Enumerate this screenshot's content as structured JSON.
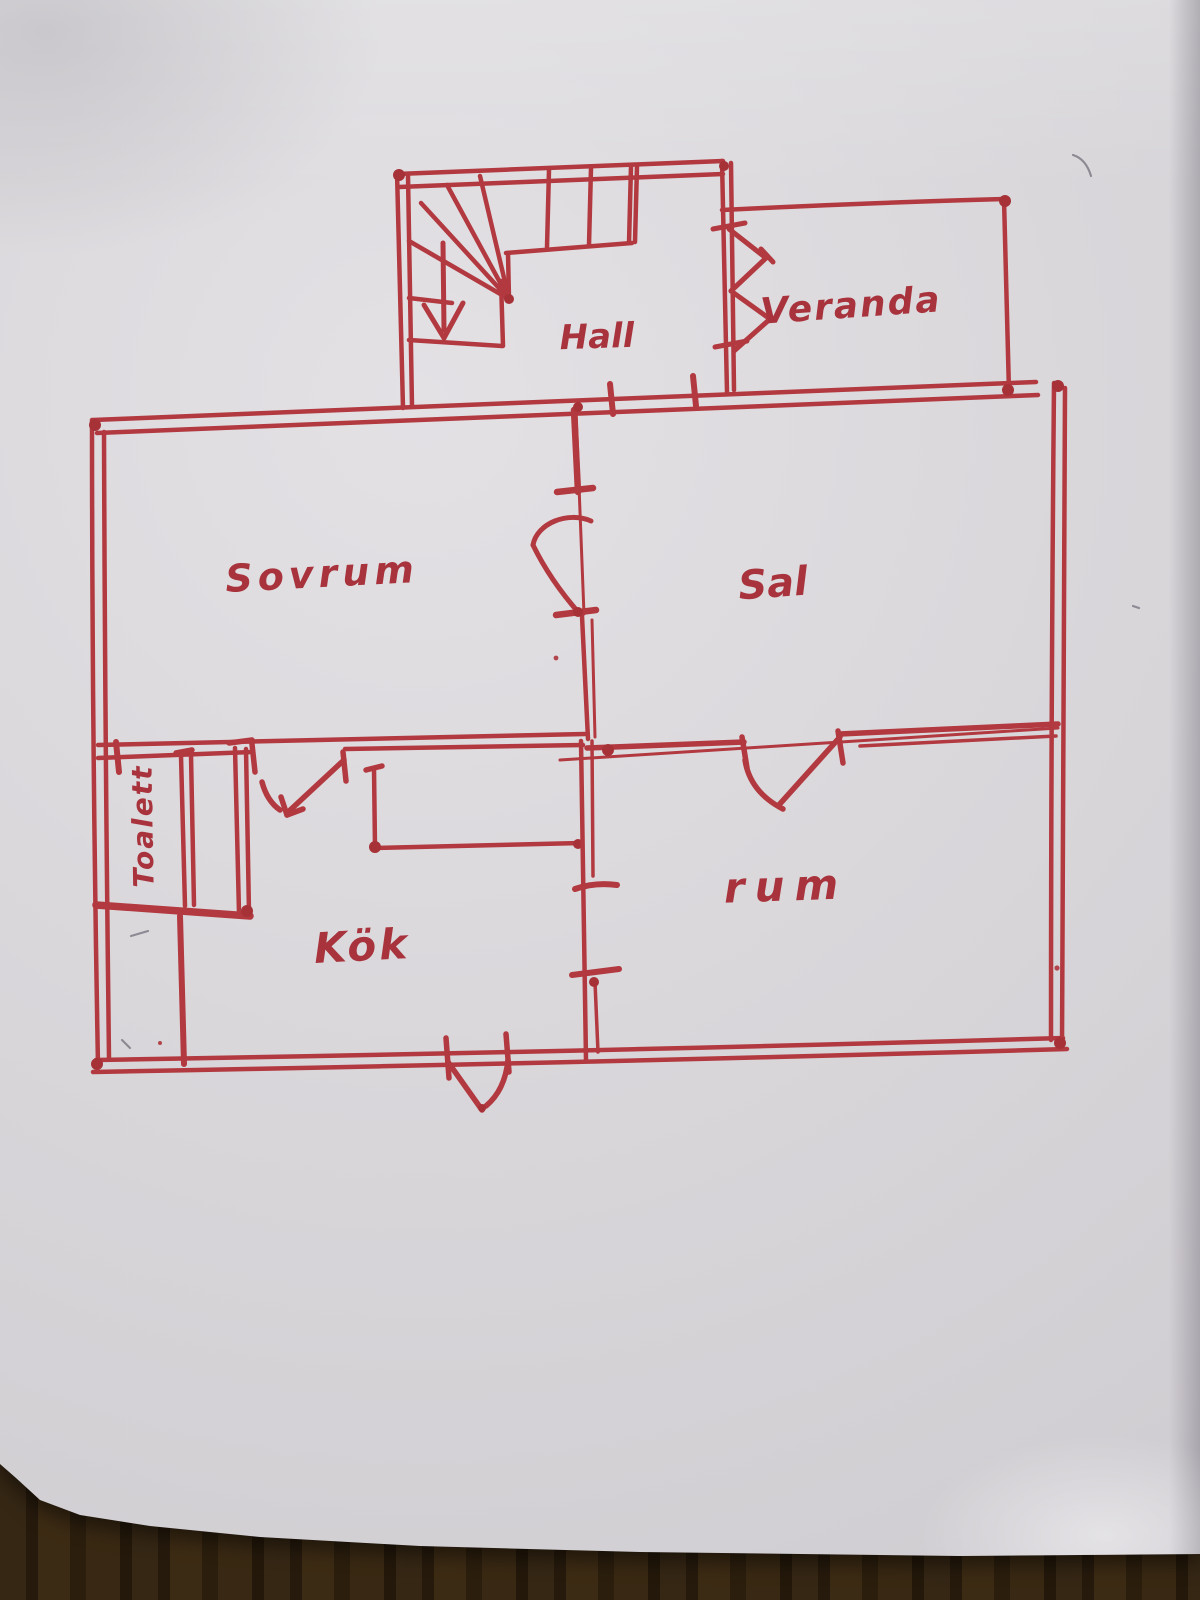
{
  "scene": {
    "description": "Hand-drawn floor plan sketched in red marker on a sheet of paper lying on a wooden table"
  },
  "colors": {
    "ink": "#b2393f",
    "ink_dark": "#a63238",
    "paper": "#d9d7da",
    "wood": "#3a2a15"
  },
  "rooms": {
    "hall": "Hall",
    "veranda": "Veranda",
    "sovrum": "Sovrum",
    "sal": "Sal",
    "toalett": "Toalett",
    "kok": "Kök",
    "rum": "rum"
  }
}
